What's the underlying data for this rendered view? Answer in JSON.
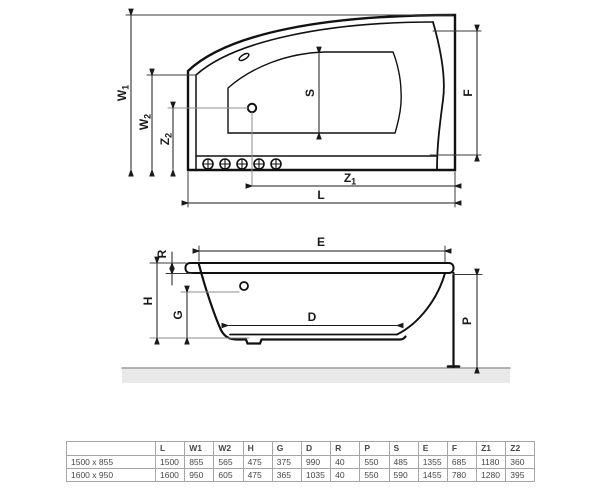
{
  "drawing": {
    "plan": {
      "labels": {
        "W1": {
          "base": "W",
          "sub": "1"
        },
        "W2": {
          "base": "W",
          "sub": "2"
        },
        "Z2": {
          "base": "Z",
          "sub": "2"
        },
        "Z1": {
          "base": "Z",
          "sub": "1"
        },
        "S": "S",
        "F": "F",
        "L": "L"
      }
    },
    "side": {
      "labels": {
        "R": "R",
        "E": "E",
        "H": "H",
        "G": "G",
        "D": "D",
        "P": "P"
      }
    }
  },
  "table": {
    "headers": [
      "",
      "L",
      "W1",
      "W2",
      "H",
      "G",
      "D",
      "R",
      "P",
      "S",
      "E",
      "F",
      "Z1",
      "Z2"
    ],
    "rows": [
      {
        "label": "1500 x 855",
        "values": [
          "1500",
          "855",
          "565",
          "475",
          "375",
          "990",
          "40",
          "550",
          "485",
          "1355",
          "685",
          "1180",
          "360"
        ]
      },
      {
        "label": "1600 x 950",
        "values": [
          "1600",
          "950",
          "605",
          "475",
          "365",
          "1035",
          "40",
          "550",
          "590",
          "1455",
          "780",
          "1280",
          "395"
        ]
      }
    ]
  },
  "colors": {
    "outline": "#111111",
    "dim_line": "#1a1a1a",
    "aux_line": "#8c8c8c",
    "floor_fill": "#e9e9e9",
    "floor_line": "#9a9a9a",
    "table_border": "#a6a6a6",
    "table_text": "#474747"
  }
}
